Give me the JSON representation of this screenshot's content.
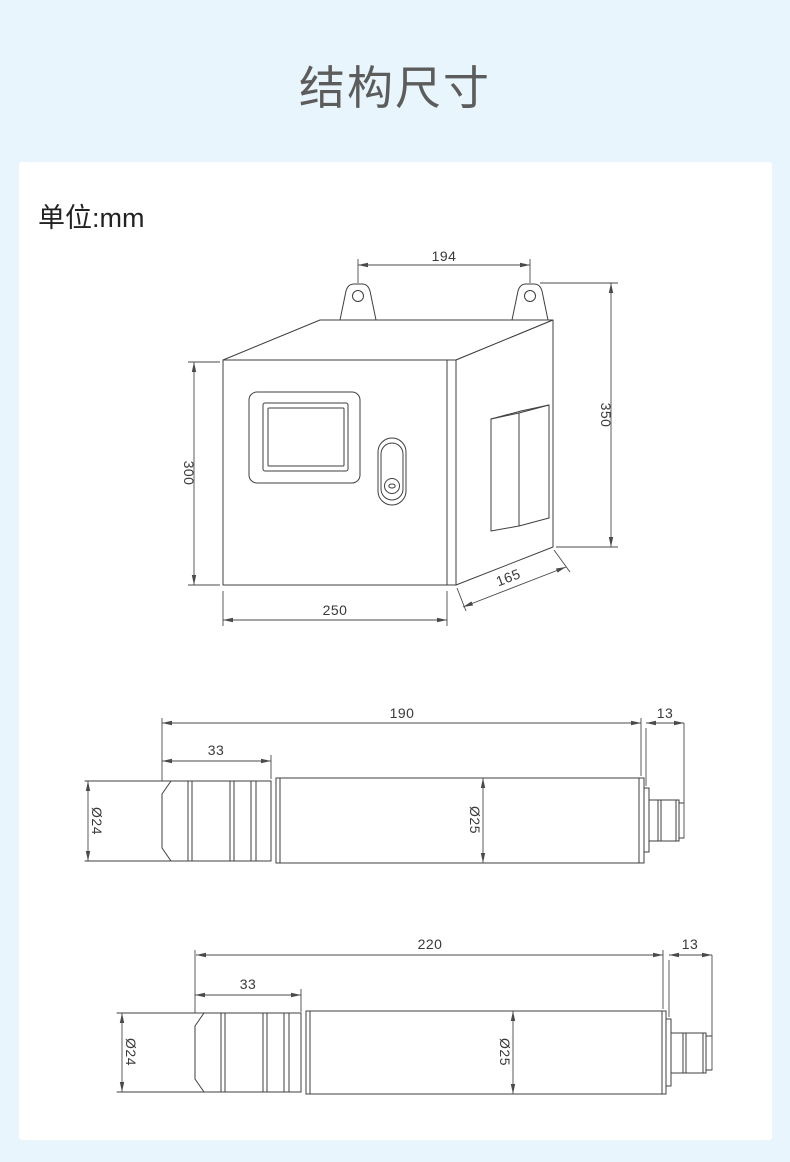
{
  "page": {
    "title": "结构尺寸",
    "unit_label": "单位:mm"
  },
  "colors": {
    "background": "#e8f5fd",
    "card": "#ffffff",
    "title_text": "#5c5c5c",
    "body_text": "#222222",
    "drawing_line": "#3f3f3f",
    "dimension_text": "#3a3a3a"
  },
  "drawings": {
    "control_box": {
      "dims": {
        "mount_spacing": "194",
        "overall_height": "350",
        "front_height": "300",
        "front_width": "250",
        "depth": "165"
      }
    },
    "sensor_a": {
      "dims": {
        "body_length": "190",
        "connector_length": "13",
        "head_length": "33",
        "head_diameter": "Ø24",
        "body_diameter": "Ø25"
      }
    },
    "sensor_b": {
      "dims": {
        "body_length": "220",
        "connector_length": "13",
        "head_length": "33",
        "head_diameter": "Ø24",
        "body_diameter": "Ø25"
      }
    }
  }
}
